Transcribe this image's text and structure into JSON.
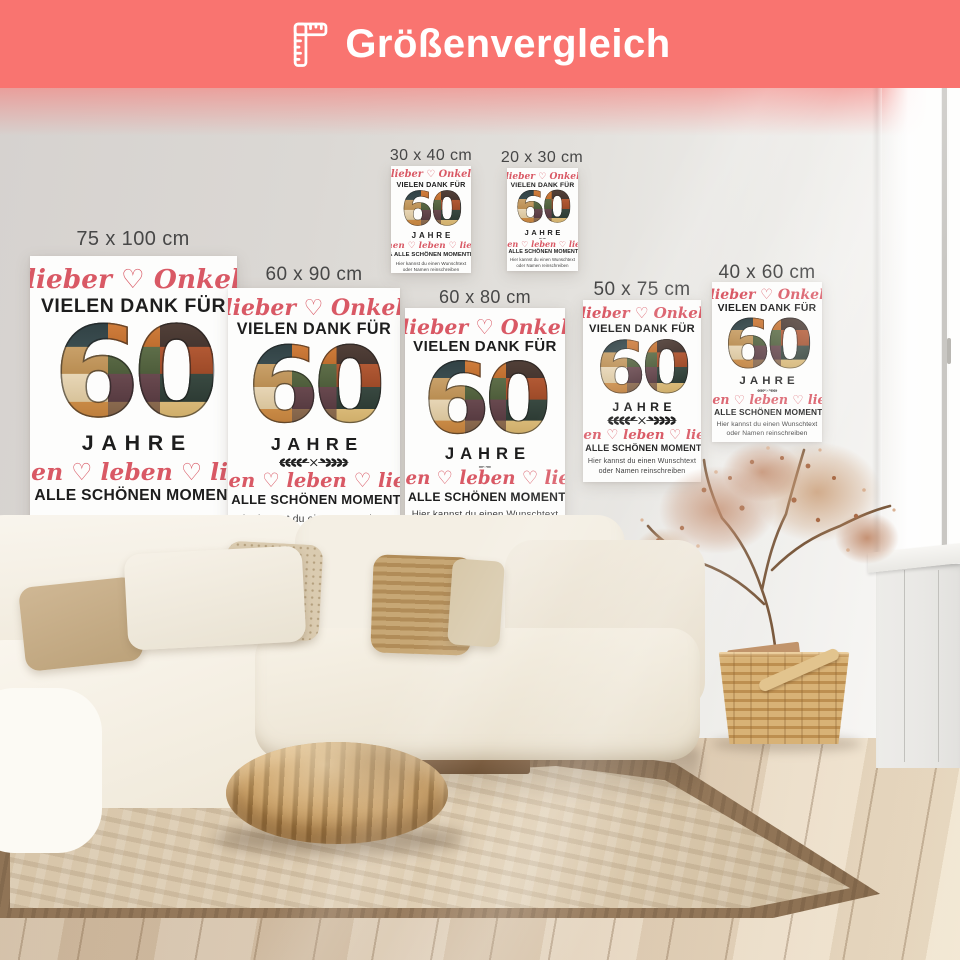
{
  "header": {
    "title": "Größenvergleich",
    "icon": "ruler-icon",
    "bg_color": "#F97470",
    "text_color": "#FFFFFF"
  },
  "sizes": [
    {
      "label": "75 x 100 cm"
    },
    {
      "label": "60 x 90 cm"
    },
    {
      "label": "30 x 40 cm"
    },
    {
      "label": "20 x 30 cm"
    },
    {
      "label": "60 x 80 cm"
    },
    {
      "label": "50 x 75 cm"
    },
    {
      "label": "40 x 60 cm"
    }
  ],
  "poster": {
    "script_top": "lieber ♡ Onkel",
    "line1": "VIELEN DANK FÜR",
    "number": "60",
    "line2": "JAHRE",
    "script_bottom": "lachen ♡ leben ♡ lieben",
    "line3": "& ALLE SCHÖNEN MOMENTE",
    "note_line1": "Hier kannst du einen Wunschtext",
    "note_line2": "oder Namen reinschreiben",
    "accent_color": "#D95965",
    "text_color": "#1D1D1D",
    "background": "#FDFDFC"
  },
  "scene": {
    "wall_color": "#DEDAD6",
    "floor_color": "#DCCBB3",
    "rug_field_color": "#D7C5A9",
    "rug_border_color": "#8F7355",
    "sofa_color": "#F4EFE5",
    "pouf_color": "#BB9058",
    "basket_color": "#CDA76C",
    "plant_color": "#B5714A",
    "window_light_color": "#FFFFFF"
  }
}
